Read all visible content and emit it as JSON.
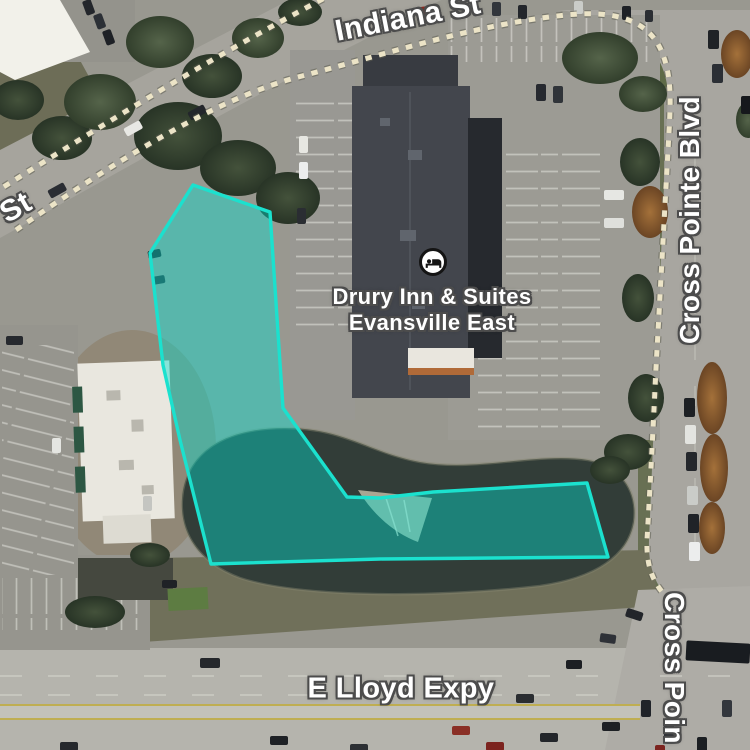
{
  "map": {
    "road_labels": [
      {
        "id": "top",
        "text": "Indiana St"
      },
      {
        "id": "left",
        "text": "St"
      },
      {
        "id": "right",
        "text": "Cross Pointe Blvd"
      },
      {
        "id": "bottom",
        "text": "E Lloyd Expy"
      },
      {
        "id": "bottom_right",
        "text": "Cross Poin"
      }
    ],
    "poi": {
      "line1": "Drury Inn & Suites",
      "line2": "Evansville East",
      "icon": "bed-icon"
    },
    "highlight": {
      "points": "193,185 270,212 283,408 347,497 380,498 433,492 587,483 608,557 380,559 211,564 180,440 163,365 150,253"
    }
  },
  "colors": {
    "highlight_stroke": "#1be1ce",
    "highlight_fill": "rgba(0,224,210,0.42)",
    "label_text": "#ffffff",
    "label_halo": "#4c4c4c",
    "road_dash": "#ece4c7"
  }
}
